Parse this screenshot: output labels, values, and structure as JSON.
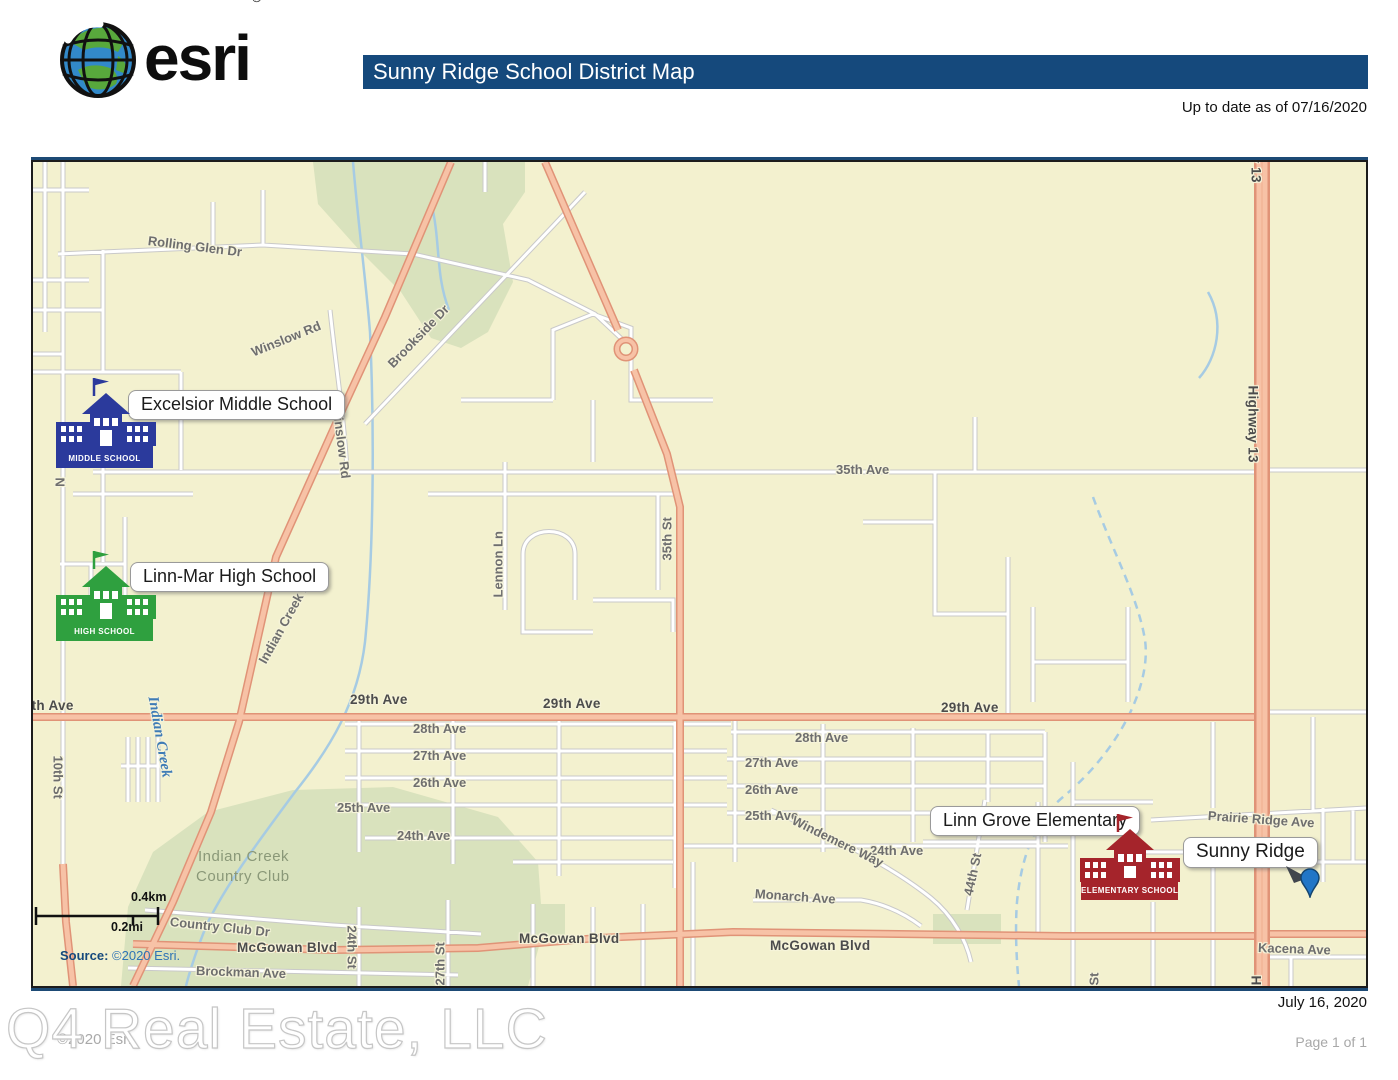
{
  "header": {
    "logo_text": "esri",
    "logo_registered": "®",
    "title": "Sunny Ridge School District Map",
    "update_note": "Up to date as of 07/16/2020"
  },
  "map": {
    "schools": [
      {
        "id": "middle",
        "callout": "Excelsior Middle School",
        "banner": "MIDDLE SCHOOL",
        "color": "#2B3A9C"
      },
      {
        "id": "high",
        "callout": "Linn-Mar High School",
        "banner": "HIGH SCHOOL",
        "color": "#2FA03F"
      },
      {
        "id": "elementary",
        "callout": "Linn Grove Elementary",
        "banner": "ELEMENTARY SCHOOL",
        "color": "#A5242B"
      }
    ],
    "pin_label": "Sunny Ridge",
    "scale": {
      "km": "0.4km",
      "mi": "0.2mi"
    },
    "source_label": "Source:",
    "source_text": "©2020 Esri.",
    "road_labels": [
      {
        "t": "Rolling Glen Dr",
        "x": 115,
        "y": 71,
        "r": 7
      },
      {
        "t": "Winslow Rd",
        "x": 219,
        "y": 183,
        "r": -22
      },
      {
        "t": "Winslow Rd",
        "x": 304,
        "y": 236,
        "r": 83
      },
      {
        "t": "Brookside Dr",
        "x": 357,
        "y": 196,
        "r": -46
      },
      {
        "t": "35th Ave",
        "x": 803,
        "y": 300,
        "r": 0
      },
      {
        "t": "35th St",
        "x": 634,
        "y": 391,
        "r": -90
      },
      {
        "t": "Lennon Ln",
        "x": 465,
        "y": 428,
        "r": -90
      },
      {
        "t": "Highway 13",
        "x": 1220,
        "y": 216,
        "r": 90,
        "c": "major"
      },
      {
        "t": "Highway 13",
        "x": 1223,
        "y": -64,
        "r": 90,
        "c": "major"
      },
      {
        "t": "Highway 13",
        "x": 1223,
        "y": 806,
        "r": 90,
        "c": "major"
      },
      {
        "t": "29th Ave",
        "x": -17,
        "y": 536,
        "r": 0,
        "c": "major"
      },
      {
        "t": "29th Ave",
        "x": 317,
        "y": 530,
        "r": 0,
        "c": "major"
      },
      {
        "t": "29th Ave",
        "x": 510,
        "y": 534,
        "r": 0,
        "c": "major"
      },
      {
        "t": "29th Ave",
        "x": 908,
        "y": 538,
        "r": 0,
        "c": "major"
      },
      {
        "t": "28th Ave",
        "x": 380,
        "y": 559,
        "r": 0
      },
      {
        "t": "28th Ave",
        "x": 762,
        "y": 568,
        "r": 0
      },
      {
        "t": "27th Ave",
        "x": 380,
        "y": 586,
        "r": 0
      },
      {
        "t": "27th Ave",
        "x": 712,
        "y": 593,
        "r": 0
      },
      {
        "t": "26th Ave",
        "x": 380,
        "y": 613,
        "r": 0
      },
      {
        "t": "26th Ave",
        "x": 712,
        "y": 620,
        "r": 0
      },
      {
        "t": "25th Ave",
        "x": 304,
        "y": 638,
        "r": 0
      },
      {
        "t": "25th Ave",
        "x": 712,
        "y": 646,
        "r": 0
      },
      {
        "t": "24th Ave",
        "x": 364,
        "y": 666,
        "r": 0
      },
      {
        "t": "24th Ave",
        "x": 837,
        "y": 681,
        "r": 0
      },
      {
        "t": "Windemere Way",
        "x": 760,
        "y": 650,
        "r": 26
      },
      {
        "t": "Monarch Ave",
        "x": 722,
        "y": 724,
        "r": 4
      },
      {
        "t": "McGowan Blvd",
        "x": 204,
        "y": 778,
        "r": 0,
        "c": "major"
      },
      {
        "t": "McGowan Blvd",
        "x": 486,
        "y": 769,
        "r": 0,
        "c": "major"
      },
      {
        "t": "McGowan Blvd",
        "x": 737,
        "y": 776,
        "r": 0,
        "c": "major"
      },
      {
        "t": "Country Club Dr",
        "x": 137,
        "y": 752,
        "r": 6
      },
      {
        "t": "Brockman Ave",
        "x": 163,
        "y": 801,
        "r": 2
      },
      {
        "t": "24th St",
        "x": 319,
        "y": 756,
        "r": 90
      },
      {
        "t": "27th St",
        "x": 407,
        "y": 816,
        "r": -90
      },
      {
        "t": "10th St",
        "x": 25,
        "y": 586,
        "r": 90
      },
      {
        "t": "44th St",
        "x": 935,
        "y": 726,
        "r": -78
      },
      {
        "t": "Prairie Ridge Ave",
        "x": 1175,
        "y": 646,
        "r": 4
      },
      {
        "t": "Kacena Ave",
        "x": 1225,
        "y": 778,
        "r": 2
      },
      {
        "t": "Indian Creek Rd",
        "x": 229,
        "y": 493,
        "r": -61
      },
      {
        "t": "N",
        "x": 27,
        "y": 308,
        "r": 90
      },
      {
        "t": "St",
        "x": 1061,
        "y": 816,
        "r": -90
      },
      {
        "t": "Indian Creek",
        "x": 119,
        "y": 526,
        "r": 80,
        "c": "creek"
      },
      {
        "t": "Indian Creek",
        "x": 165,
        "y": 686,
        "r": 0,
        "c": "area"
      },
      {
        "t": "Country Club",
        "x": 163,
        "y": 706,
        "r": 0,
        "c": "area"
      }
    ]
  },
  "footer": {
    "date": "July 16, 2020",
    "watermark": "Q4 Real Estate, LLC",
    "copyright": "©2020 Esri",
    "page": "Page 1 of 1"
  },
  "theme": {
    "title_bar": "#15497C",
    "map_bg": "#F3F1CF",
    "park_green": "#D9E2BD",
    "road_major_fill": "#F7C2A6",
    "road_major_casing": "#E09377",
    "water": "#A6CBE3",
    "pin_blue": "#2176C7"
  }
}
